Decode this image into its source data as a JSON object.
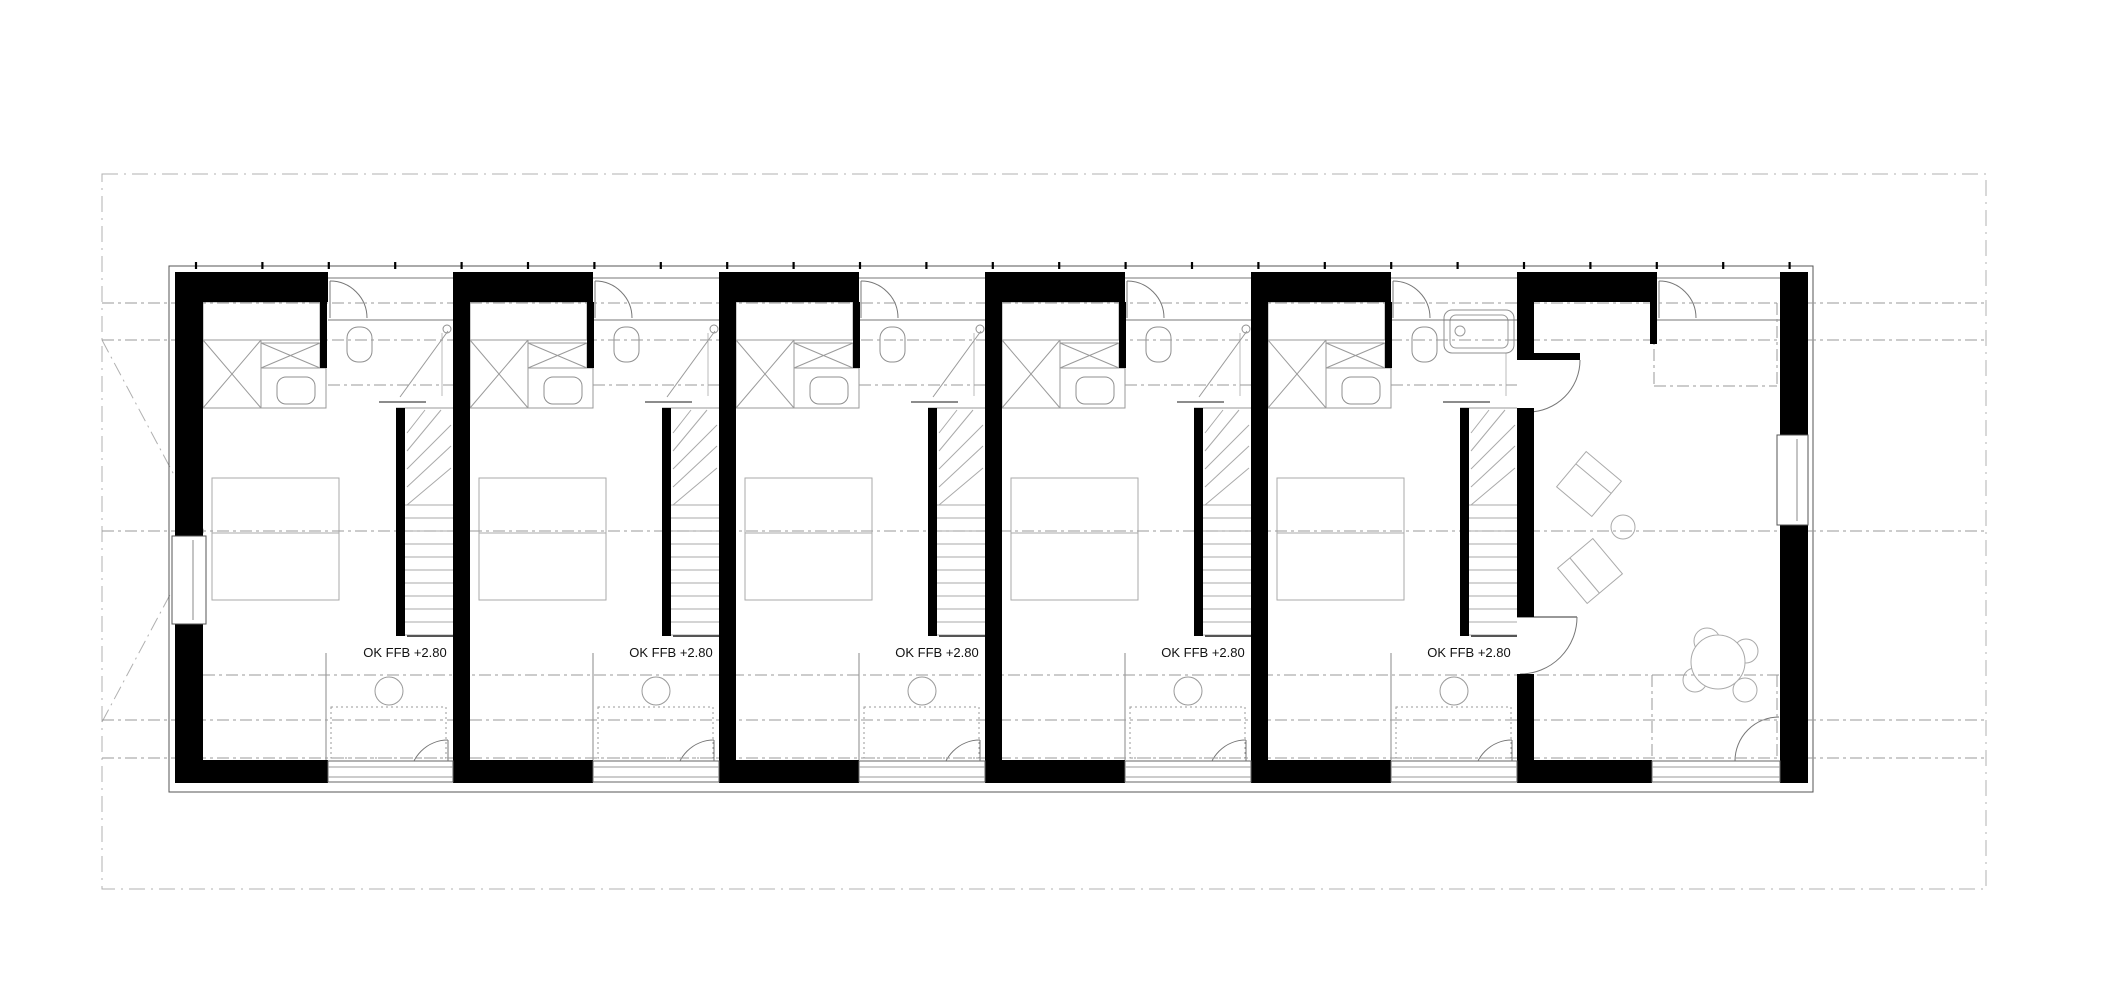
{
  "page": {
    "width": 2122,
    "height": 998,
    "background": "#ffffff"
  },
  "labels": {
    "floor_level_text": "OK FFB +2.80",
    "font_size": 13,
    "positions": [
      [
        405,
        657
      ],
      [
        671,
        657
      ],
      [
        937,
        657
      ],
      [
        1203,
        657
      ],
      [
        1469,
        657
      ]
    ]
  },
  "colors": {
    "wall": "#000000",
    "outline": "#555555",
    "fixture": "#8f8f8f",
    "light": "#aaaaaa",
    "door": "#777777",
    "axis": "#9a9a9a",
    "boundary": "#b0b0b0",
    "text": "#111111",
    "white": "#ffffff"
  },
  "plan": {
    "boundary": [
      102,
      174,
      1986,
      889
    ],
    "hip_diagonals": [
      [
        102,
        340,
        204,
        531
      ],
      [
        102,
        722,
        204,
        531
      ]
    ],
    "outline": [
      169,
      266,
      1813,
      792
    ],
    "outline_tick_start": 196,
    "outline_tick_step": 66.4,
    "axes_full": [
      303,
      340,
      531,
      720,
      758
    ],
    "axis_inner": [
      675,
      180,
      1805
    ],
    "walls": {
      "top_y": 272,
      "top_h": 30,
      "bottom_y": 760,
      "bottom_h": 23,
      "left_x": 175,
      "left_w": 28,
      "right_x": 1780,
      "right_w": 28,
      "left_window_gap": [
        536,
        624
      ],
      "right_window_gap": [
        435,
        525
      ]
    },
    "top_chunks": [
      [
        175,
        328
      ],
      [
        453,
        593
      ],
      [
        719,
        859
      ],
      [
        985,
        1125
      ],
      [
        1251,
        1391
      ],
      [
        1517,
        1657
      ]
    ],
    "bottom_chunks": [
      [
        175,
        328
      ],
      [
        453,
        593
      ],
      [
        719,
        859
      ],
      [
        985,
        1125
      ],
      [
        1251,
        1391
      ],
      [
        1517,
        1652
      ]
    ],
    "bottom_windows": [
      [
        328,
        453
      ],
      [
        593,
        719
      ],
      [
        859,
        985
      ],
      [
        1125,
        1251
      ],
      [
        1391,
        1517
      ],
      [
        1652,
        1780
      ]
    ],
    "entry_openings": [
      [
        328,
        453
      ],
      [
        593,
        719
      ],
      [
        859,
        985
      ],
      [
        1125,
        1251
      ],
      [
        1391,
        1517
      ],
      [
        1657,
        1780
      ]
    ],
    "dividers": [
      453,
      719,
      985,
      1251
    ],
    "divider_w": 17,
    "divider5": {
      "x": 1517,
      "segments": [
        [
          272,
          353
        ],
        [
          408,
          617
        ],
        [
          674,
          783
        ]
      ],
      "stub": [
        1517,
        353,
        63,
        7
      ]
    },
    "units": [
      {
        "x0": 203,
        "x1": 453,
        "bathtub": false
      },
      {
        "x0": 470,
        "x1": 719,
        "bathtub": false
      },
      {
        "x0": 736,
        "x1": 985,
        "bathtub": false
      },
      {
        "x0": 1002,
        "x1": 1251,
        "bathtub": false
      },
      {
        "x0": 1268,
        "x1": 1517,
        "bathtub": true
      }
    ],
    "living": {
      "x0": 1534,
      "lleg": [
        1650,
        302,
        7,
        42
      ],
      "entry_leaf_x": 1659,
      "top_door_arc": [
        1580,
        360,
        1528,
        412,
        52
      ],
      "room_door_leaf": [
        1517,
        617,
        1577,
        617
      ],
      "room_door_arc": [
        1577,
        617,
        1520,
        674,
        57
      ],
      "terrace_arc": [
        1735,
        761,
        1779,
        717,
        44
      ],
      "dash_box_top": [
        1654,
        303,
        1777,
        386
      ],
      "dash_box_bottom": [
        1652,
        675,
        1777,
        758
      ],
      "armchairs": [
        {
          "cx": 1589,
          "cy": 484,
          "rot": 40,
          "seat": -7
        },
        {
          "cx": 1590,
          "cy": 571,
          "rot": 50,
          "seat": 7
        }
      ],
      "side_table": [
        1623,
        527,
        12
      ],
      "table": [
        1718,
        662,
        27
      ],
      "chairs": [
        [
          1707,
          641,
          13
        ],
        [
          1746,
          651,
          12
        ],
        [
          1695,
          680,
          12
        ],
        [
          1745,
          690,
          12
        ]
      ]
    }
  }
}
